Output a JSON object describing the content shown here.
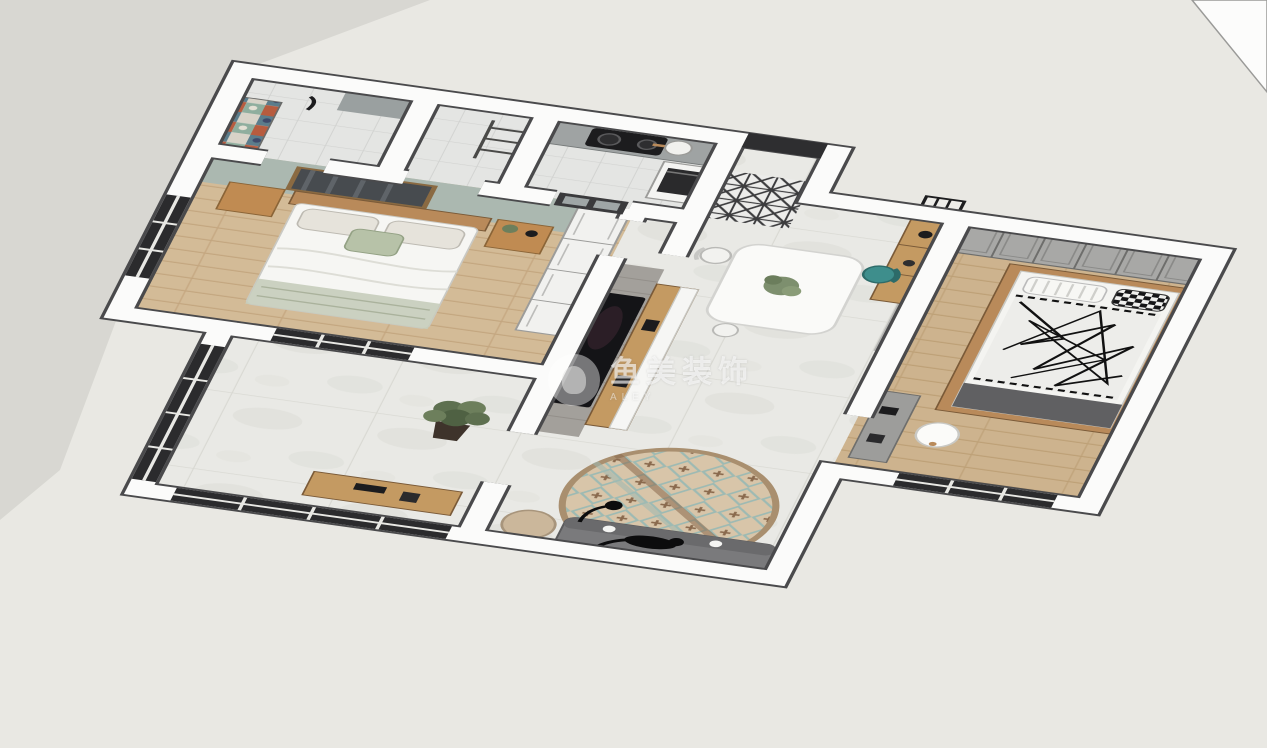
{
  "scene": {
    "type": "3d-floorplan-dollhouse-render",
    "style": "sketchup-like interior design visualization, two-bedroom apartment viewed from above at an angle",
    "watermark": {
      "logo": "circular-figure-logo",
      "text_cn": "鱼美装饰",
      "text_en": "ALEY"
    },
    "palette": {
      "outside_ground_dark": "#d8d7d2",
      "outside_ground_light": "#e9e8e3",
      "wall_white": "#fbfbfa",
      "wall_edge": "#4a4a4c",
      "marble_floor": "#e8e8e4",
      "wood_floor_master": "#d3bb97",
      "wood_floor_bedroom2": "#cdb38e",
      "sage_accent_wall": "#abb8b0",
      "tv_brick_wall": "#a3a09b",
      "gray_wall": "#b5b5b3",
      "wardrobe_gray": "#a8a8a6",
      "furniture_wood": "#c49a62",
      "teal_chair": "#3e8e8c",
      "black": "#1c1c1e"
    },
    "rooms": [
      {
        "name": "bathroom",
        "position": "top-left",
        "features": [
          "white square wall tiles",
          "multicolor patchwork mosaic accent wall",
          "gray vanity counter",
          "black shower fixture"
        ]
      },
      {
        "name": "hallway-utility",
        "position": "top-center-left",
        "features": [
          "ladder shelf rack",
          "tiled walls"
        ]
      },
      {
        "name": "kitchen",
        "position": "top-center",
        "features": [
          "white subway tile walls",
          "gray countertop",
          "black two-burner gas cooktop",
          "white pot",
          "tall white cabinet with built-in black oven",
          "dark framed glass door"
        ]
      },
      {
        "name": "entry-foyer",
        "position": "center-top",
        "features": [
          "black entry door",
          "black-and-white patterned cement floor tiles",
          "gray brick niche wall"
        ]
      },
      {
        "name": "dining-area",
        "position": "center-right",
        "features": [
          "white dining table",
          "green plant centerpiece",
          "teal dining chair",
          "white dining chair",
          "wood sideboard with black vase and table lamp",
          "black metal wall shelf with three compartments",
          "gray feature wall"
        ]
      },
      {
        "name": "living-room",
        "position": "center",
        "features": [
          "large marble floor tiles",
          "gray brick TV accent wall",
          "wall-mounted black flat TV",
          "wood and white low TV console with black speakers",
          "round patterned rug in beige-teal-brown",
          "gray sofa with black cat and two white cups",
          "beige armchair",
          "black floor lamp"
        ]
      },
      {
        "name": "balcony",
        "position": "bottom-left",
        "features": [
          "black framed floor-to-ceiling windows",
          "potted fiddle-leaf plant in dark pot",
          "wood desk with black accessories",
          "marble floor continues"
        ]
      },
      {
        "name": "master-bedroom",
        "position": "left",
        "features": [
          "sage green headboard accent wall",
          "dark abstract framed artwork",
          "wood headboard double bed with white bedding",
          "patterned pillows and green throw",
          "two wood nightstands",
          "plant and black alarm clock on nightstand",
          "white paneled wardrobe",
          "black framed window",
          "wood plank floor"
        ]
      },
      {
        "name": "second-bedroom",
        "position": "right",
        "features": [
          "full-wall gray shaker-panel wardrobe",
          "wood platform tatami bed",
          "black-and-white scribble print duvet",
          "black-white checkered pillow",
          "striped white pillow",
          "dark gray mattress base",
          "white shell chair with wood legs",
          "gray desk with black accessories",
          "black framed window",
          "light wood plank floor"
        ]
      }
    ]
  }
}
